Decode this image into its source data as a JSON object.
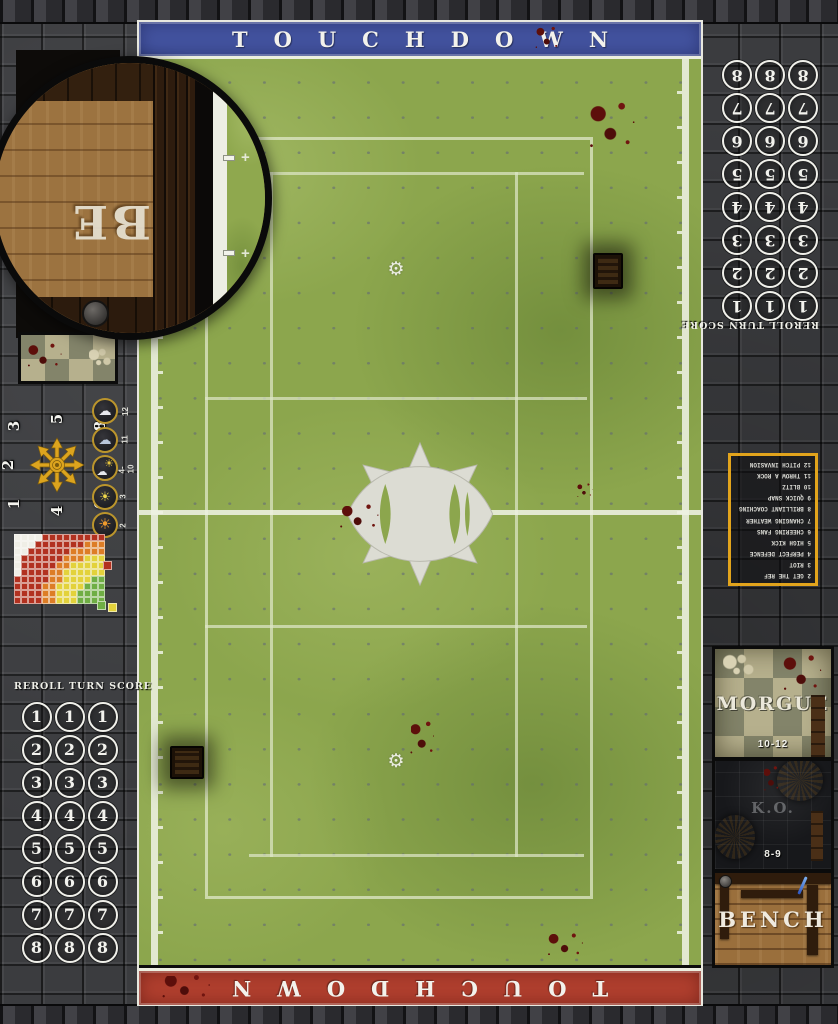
{
  "banners": {
    "top_label": "TOUCHDOWN",
    "bottom_label": "TOUCHDOWN",
    "top_color": "#4353a0",
    "bottom_color": "#b13f2e"
  },
  "turn_tracks": {
    "left_header": "REROLL TURN SCORE",
    "right_header": "REROLL TURN SCORE",
    "numbers": [
      1,
      2,
      3,
      4,
      5,
      6,
      7,
      8
    ],
    "columns_per_row": 3
  },
  "scatter_template": {
    "numbers": [
      "1",
      "2",
      "3",
      "4",
      "5",
      "6",
      "7",
      "8"
    ],
    "arrow_color": "#dca41e"
  },
  "weather_table": {
    "items": [
      {
        "icon": "blizzard-cloud-icon",
        "roll": "12"
      },
      {
        "icon": "rain-cloud-icon",
        "roll": "11"
      },
      {
        "icon": "sun-and-cloud-icon",
        "roll": "4-10"
      },
      {
        "icon": "sun-icon",
        "roll": "3"
      },
      {
        "icon": "scorching-sun-icon",
        "roll": "2"
      }
    ]
  },
  "range_ruler": {
    "palette": {
      "G": "#6fae44",
      "Y": "#e3d23b",
      "O": "#dd7d26",
      "R": "#b23120",
      "W": "#efeee6"
    },
    "rows": [
      "WWWWRRRRRRRRR",
      "WWWRRRRRRROOO",
      "WWRRRRRROOOOO",
      "WRRRRRROOOYYY",
      "WRRRRROOYYYYY",
      "WRRRROOYYYYYY",
      "RRRRROOYYYYGG",
      "RRRROOYYYYGGG",
      "RRRROOYYYGGGG",
      "RRRROOYYYGGGG"
    ],
    "legend": {
      "red": "#b23120",
      "green": "#6fae44",
      "yellow": "#e3d23b"
    }
  },
  "kickoff_table": {
    "border_color": "#e2a41c",
    "rows": [
      {
        "roll": "2",
        "event": "GET THE REF"
      },
      {
        "roll": "3",
        "event": "RIOT"
      },
      {
        "roll": "4",
        "event": "PERFECT DEFENCE"
      },
      {
        "roll": "5",
        "event": "HIGH KICK"
      },
      {
        "roll": "6",
        "event": "CHEERING FANS"
      },
      {
        "roll": "7",
        "event": "CHANGING WEATHER"
      },
      {
        "roll": "8",
        "event": "BRILLIANT COACHING"
      },
      {
        "roll": "9",
        "event": "QUICK SNAP"
      },
      {
        "roll": "10",
        "event": "BLITZ"
      },
      {
        "roll": "11",
        "event": "THROW A ROCK"
      },
      {
        "roll": "12",
        "event": "PITCH INVASION"
      }
    ]
  },
  "dugouts": {
    "right": {
      "morgue_label": "MORGUE",
      "morgue_range": "10-12",
      "ko_label": "K.O.",
      "ko_range": "8-9",
      "bench_label": "BENCH"
    },
    "left": {
      "bench_label_partial": "BE"
    }
  },
  "pitch": {
    "grass_color": "#8ca64d",
    "line_color": "#e9ecdc"
  }
}
